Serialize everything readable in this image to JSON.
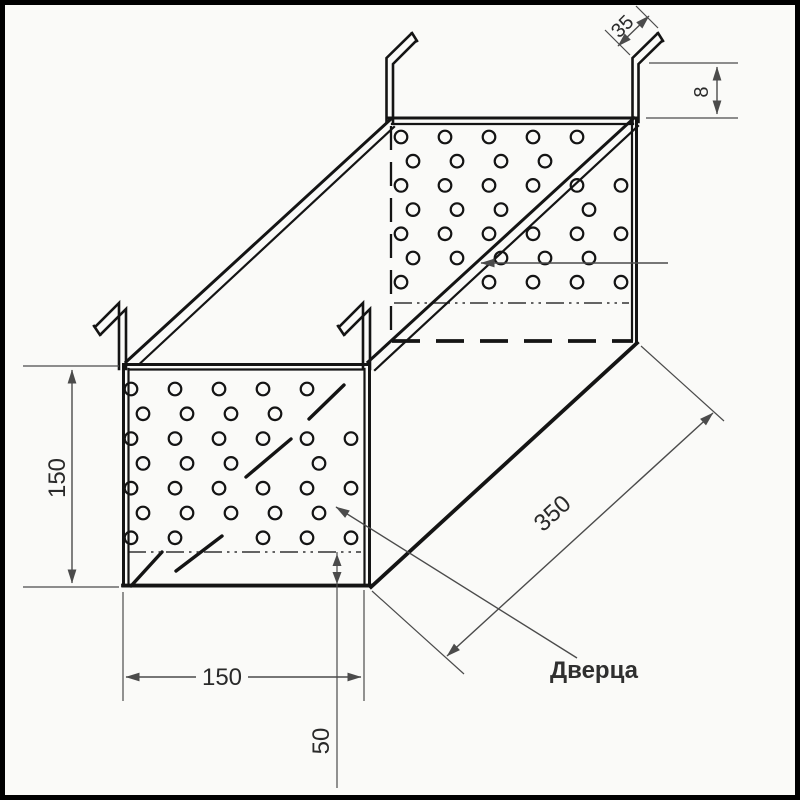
{
  "drawing": {
    "door_label": "Дверца",
    "dims": {
      "front_height": "150",
      "front_width": "150",
      "bottom_zone": "50",
      "depth": "350",
      "hook_lip": "35",
      "hook_offset": "8"
    },
    "colors": {
      "object_line": "#141414",
      "dim_line": "#4b4b4b",
      "background": "#fafaf8",
      "frame": "#000000",
      "text": "#2a2a2a"
    },
    "perforation": {
      "front": {
        "y0": 389,
        "dy": 24.8,
        "rows": 7,
        "even_x": [
          131,
          175,
          219,
          263,
          307,
          351
        ],
        "odd_x": [
          143,
          187,
          231,
          275,
          319
        ],
        "radius": 6.3
      },
      "back": {
        "y0": 137,
        "dy": 24.2,
        "rows": 7,
        "even_x": [
          401,
          445,
          489,
          533,
          577,
          621
        ],
        "odd_x": [
          413,
          457,
          501,
          545,
          589
        ],
        "radius": 6.3
      }
    },
    "break_marks": [
      [
        131,
        586,
        162,
        552
      ],
      [
        176,
        571,
        222,
        536
      ],
      [
        246,
        477,
        291,
        439
      ],
      [
        309,
        419,
        344,
        385
      ]
    ],
    "wall_edge_skip": [
      [
        368,
        362,
        634,
        118
      ]
    ],
    "skip_threshold": 9
  }
}
